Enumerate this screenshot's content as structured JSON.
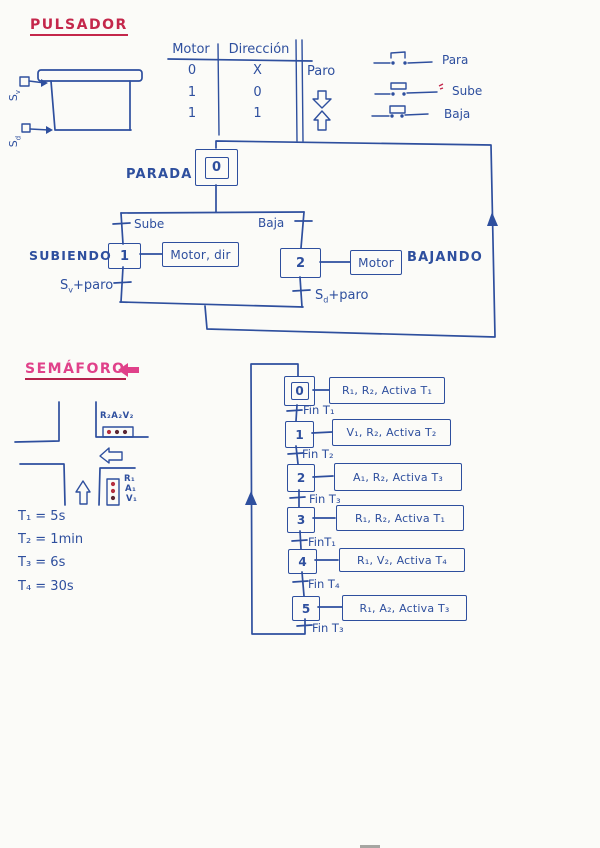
{
  "page": {
    "colors": {
      "ink": "#2e4f9e",
      "red": "#c4274b",
      "pink": "#e0418a",
      "paper": "#fbfbf8",
      "lamp-red": "#b53040",
      "lamp-dark": "#5c2733"
    }
  },
  "pulsador": {
    "title": "PULSADOR",
    "shutter": {
      "sensor_top": {
        "base": "S",
        "sub": "v"
      },
      "sensor_bottom": {
        "base": "S",
        "sub": "d"
      }
    },
    "table": {
      "headers": [
        "Motor",
        "Dirección"
      ],
      "rows": [
        [
          "0",
          "X"
        ],
        [
          "1",
          "0"
        ],
        [
          "1",
          "1"
        ]
      ],
      "result": {
        "paro": "Paro",
        "down_icon": "hollow-down-arrow",
        "up_icon": "hollow-up-arrow"
      }
    },
    "buttons": [
      {
        "label": "Para"
      },
      {
        "label": "Sube"
      },
      {
        "label": "Baja"
      }
    ]
  },
  "grafcet_motor": {
    "initial_state": {
      "num": "0",
      "name": "PARADA"
    },
    "left": {
      "transition": "Sube",
      "state": "1",
      "name": "SUBIENDO",
      "action": "Motor, dir",
      "exit_base": "S",
      "exit_sub": "v",
      "exit_rest": "+paro"
    },
    "right": {
      "transition": "Baja",
      "state": "2",
      "name": "BAJANDO",
      "action": "Motor",
      "exit_base": "S",
      "exit_sub": "d",
      "exit_rest": "+paro"
    }
  },
  "semaforo": {
    "title": "SEMÁFORO",
    "crossing": {
      "light_h_label": "R₂A₂V₂",
      "light_v_labels": [
        "R₁",
        "A₁",
        "V₁"
      ]
    },
    "timers": [
      "T₁ = 5s",
      "T₂ = 1min",
      "T₃ = 6s",
      "T₄ = 30s"
    ],
    "steps": [
      {
        "num": "0",
        "action": "R₁, R₂, Activa T₁",
        "transition": "Fin T₁"
      },
      {
        "num": "1",
        "action": "V₁, R₂, Activa T₂",
        "transition": "Fin T₂"
      },
      {
        "num": "2",
        "action": "A₁, R₂, Activa T₃",
        "transition": "Fin T₃"
      },
      {
        "num": "3",
        "action": "R₁, R₂, Activa T₁",
        "transition": "FinT₁"
      },
      {
        "num": "4",
        "action": "R₁, V₂, Activa T₄",
        "transition": "Fin T₄"
      },
      {
        "num": "5",
        "action": "R₁, A₂, Activa T₃",
        "transition": "Fin T₃"
      }
    ]
  }
}
